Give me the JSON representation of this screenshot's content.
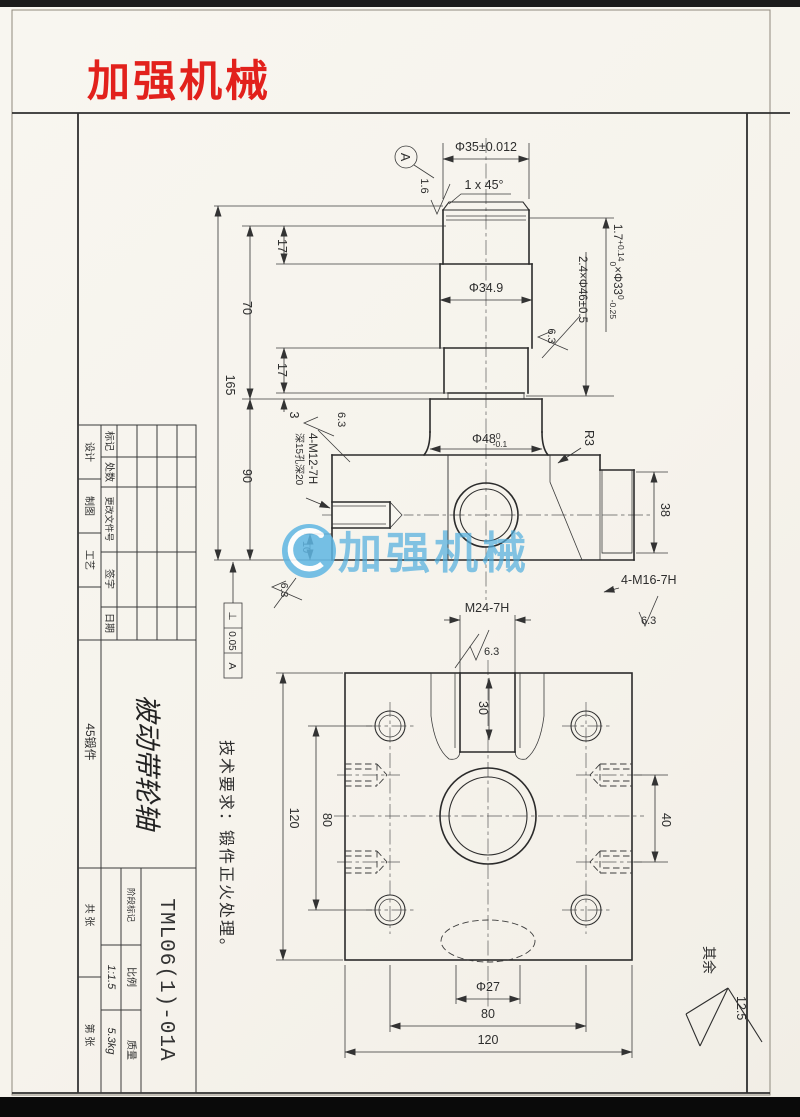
{
  "logo": {
    "text": "加强机械",
    "color": "#e2211c"
  },
  "watermark": {
    "text": "加强机械",
    "color": "#4faede"
  },
  "notes": {
    "tech": "技术要求：锻件正火处理。",
    "others_prefix": "其余",
    "others_value": "12.5"
  },
  "dims": {
    "d35": "Φ35±0.012",
    "chamfer": "1 x 45°",
    "datum_a": "A",
    "ra_16": "1.6",
    "ra_63": "6.3",
    "d349": "Φ34.9",
    "groove_a": "1.7",
    "groove_a_sup": "+0.14",
    "groove_a_sub": "0",
    "groove_b": "×Φ33",
    "groove_b_sup": "0",
    "groove_b_sub": "-0.25",
    "groove2": "2.4×Φ46±0.5",
    "d48": "Φ48",
    "d48_sup": "0",
    "d48_sub": "-0.1",
    "r3": "R3",
    "h38": "38",
    "m16": "4-M16-7H",
    "m12_line1": "4-M12-7H",
    "m12_line2": "深15孔深20",
    "m24": "M24-7H",
    "gdt_sym": "⊥",
    "gdt_val": "0.05",
    "gdt_datum": "A",
    "len165": "165",
    "len70": "70",
    "len90": "90",
    "len17_top": "17",
    "len17_low": "17",
    "len3": "3",
    "len10": "10",
    "plan_120_left": "120",
    "plan_80_left": "80",
    "plan_30": "30",
    "plan_40": "40",
    "plan_d27": "Φ27",
    "plan_80_bottom": "80",
    "plan_120_bottom": "120"
  },
  "title_block": {
    "rev_headers": [
      "标记",
      "处数",
      "更改文件号",
      "签字",
      "日期"
    ],
    "sign_rows": [
      "设计",
      "制图",
      "工艺"
    ],
    "material": "45锻件",
    "part_name": "被动带轮轴",
    "drawing_no": "TML06(1)-01A",
    "stage_label": "阶段标记",
    "scale_label": "比例",
    "scale_value": "1:1.5",
    "mass_label": "质量",
    "mass_value": "5.3kg",
    "sheet_total": "共  张",
    "sheet_no": "第  张"
  }
}
